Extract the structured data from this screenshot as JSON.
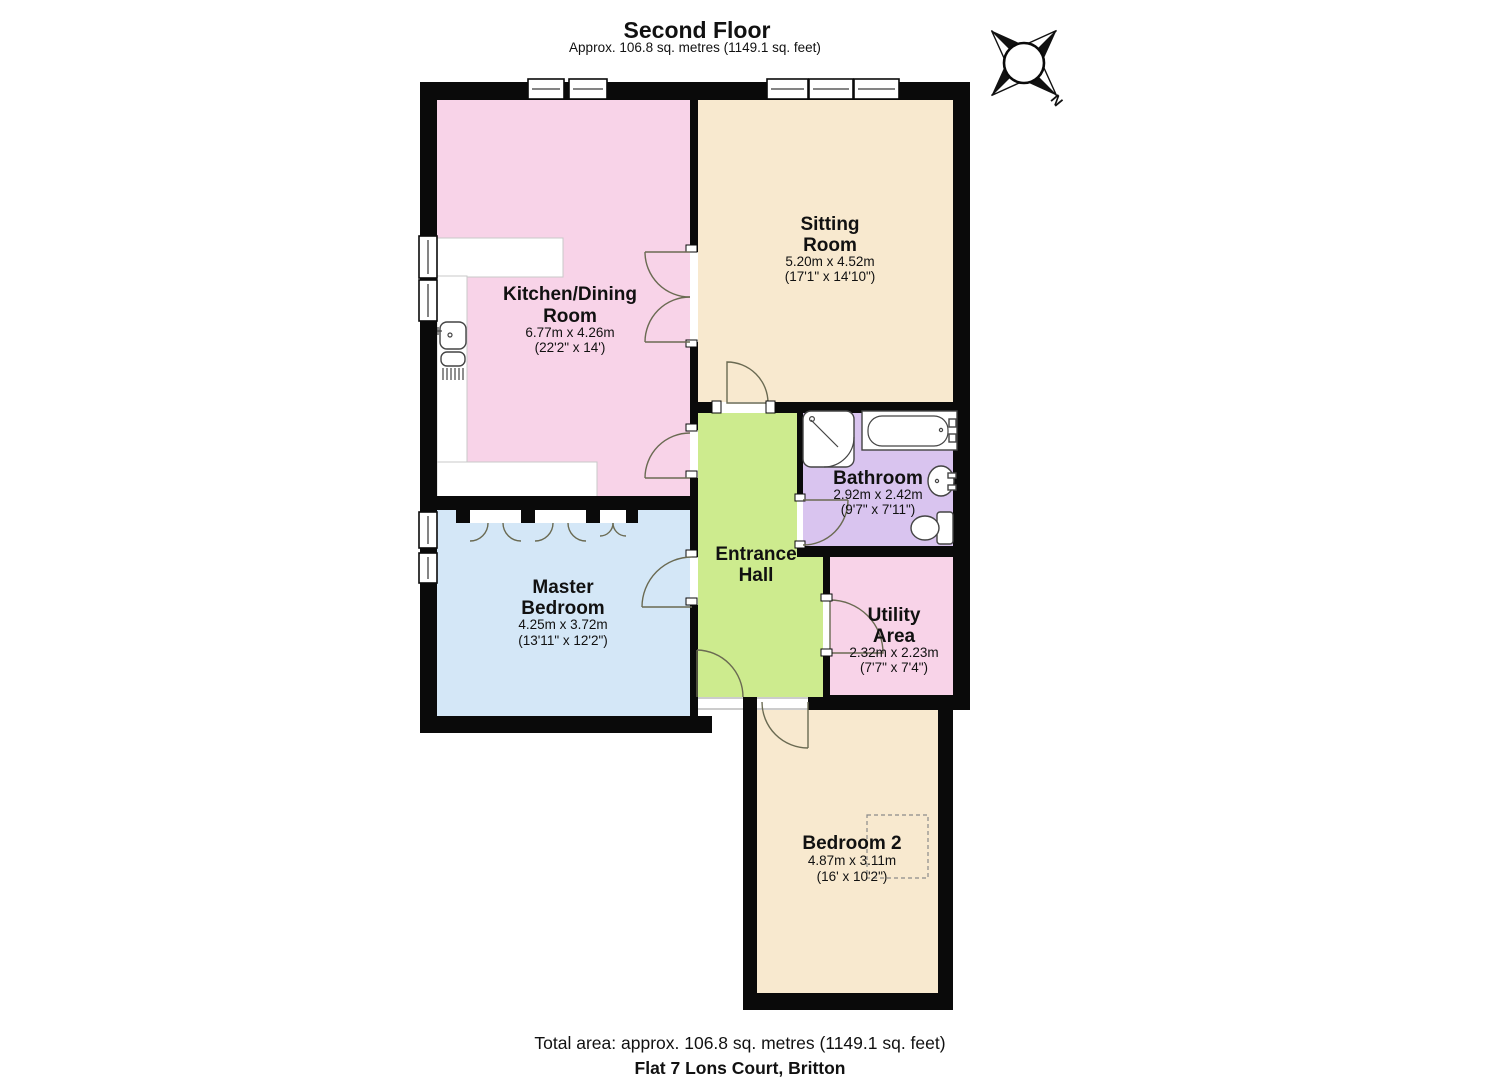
{
  "header": {
    "title": "Second Floor",
    "subtitle": "Approx. 106.8 sq. metres (1149.1 sq. feet)"
  },
  "compass": {
    "north_label": "N"
  },
  "rooms": {
    "kitchen_dining": {
      "name_line1": "Kitchen/Dining",
      "name_line2": "Room",
      "dims_metric": "6.77m x 4.26m",
      "dims_imperial": "(22'2\" x 14')"
    },
    "sitting_room": {
      "name_line1": "Sitting",
      "name_line2": "Room",
      "dims_metric": "5.20m x 4.52m",
      "dims_imperial": "(17'1\" x 14'10\")"
    },
    "bathroom": {
      "name": "Bathroom",
      "dims_metric": "2.92m x 2.42m",
      "dims_imperial": "(9'7\" x 7'11\")"
    },
    "entrance_hall": {
      "name_line1": "Entrance",
      "name_line2": "Hall"
    },
    "utility_area": {
      "name_line1": "Utility",
      "name_line2": "Area",
      "dims_metric": "2.32m x 2.23m",
      "dims_imperial": "(7'7\" x 7'4\")"
    },
    "master_bedroom": {
      "name_line1": "Master",
      "name_line2": "Bedroom",
      "dims_metric": "4.25m x 3.72m",
      "dims_imperial": "(13'11\" x 12'2\")"
    },
    "bedroom_2": {
      "name": "Bedroom 2",
      "dims_metric": "4.87m x 3.11m",
      "dims_imperial": "(16' x 10'2\")"
    }
  },
  "footer": {
    "total_area": "Total area: approx. 106.8 sq. metres (1149.1 sq. feet)",
    "address": "Flat 7 Lons Court, Britton"
  },
  "colors": {
    "wall": "#0a0a0a",
    "kitchen": "#f8d3e8",
    "sitting": "#f8e9cf",
    "bathroom": "#d9c4ef",
    "hall": "#cdeb8e",
    "master": "#d4e7f7",
    "utility": "#f8d3e8",
    "bedroom2": "#f8e9cf"
  }
}
